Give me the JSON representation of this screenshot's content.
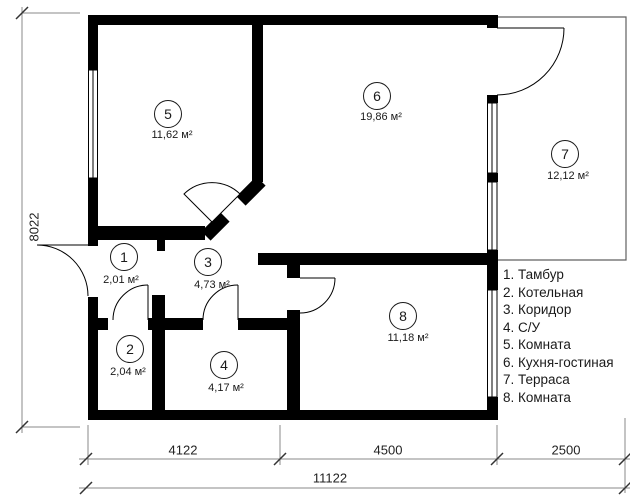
{
  "title": "Floor plan",
  "rooms": [
    {
      "number": "1",
      "area": "2,01 м²"
    },
    {
      "number": "2",
      "area": "2,04 м²"
    },
    {
      "number": "3",
      "area": "4,73 м²"
    },
    {
      "number": "4",
      "area": "4,17 м²"
    },
    {
      "number": "5",
      "area": "11,62 м²"
    },
    {
      "number": "6",
      "area": "19,86 м²"
    },
    {
      "number": "7",
      "area": "12,12 м²"
    },
    {
      "number": "8",
      "area": "11,18 м²"
    }
  ],
  "legend": {
    "items": [
      "1. Тамбур",
      "2. Котельная",
      "3. Коридор",
      "4. С/У",
      "5. Комната",
      "6. Кухня-гостиная",
      "7. Терраса",
      "8. Комната"
    ]
  },
  "dimensions": {
    "left_height": "8022",
    "bottom_segments": [
      "4122",
      "4500",
      "2500"
    ],
    "bottom_total": "11122"
  },
  "colors": {
    "wall": "#000000",
    "dimension_line": "#8a8a8a",
    "tick": "#333333",
    "terrace_outline": "#606060",
    "text": "#1a1a1a"
  }
}
